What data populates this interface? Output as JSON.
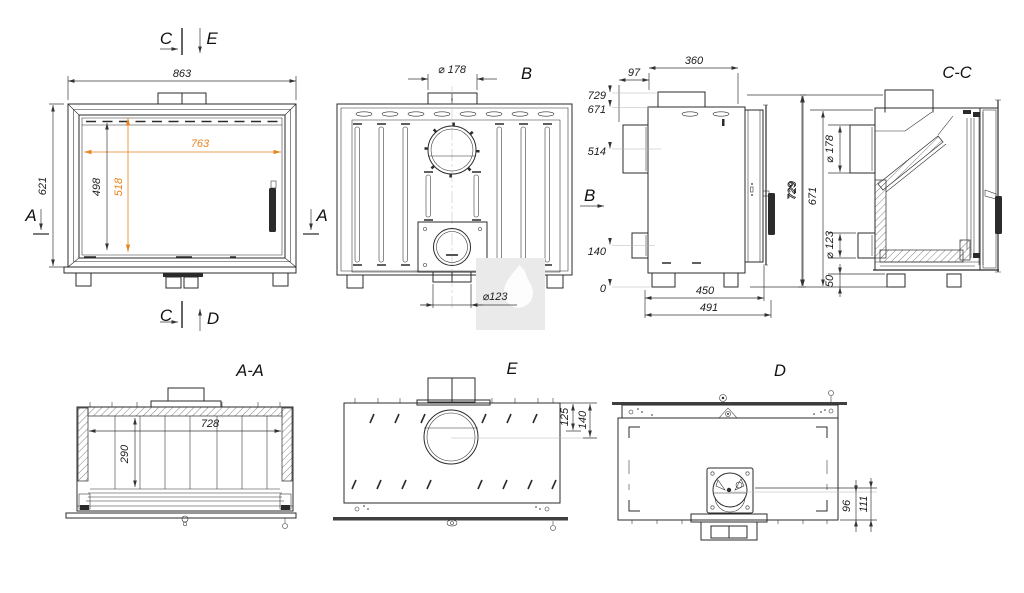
{
  "colors": {
    "line": "#2b2b2b",
    "dimension": "#3a3a3a",
    "accent_orange": "#e8831d",
    "leader_gray": "#b5b5b5",
    "watermark_bg": "#eaeaea"
  },
  "watermark": {
    "icon": "flame-icon"
  },
  "views": {
    "front": {
      "markers": {
        "c_top": "C",
        "e_top": "E",
        "a_left": "A",
        "a_right": "A",
        "c_bottom": "C",
        "d_bottom": "D"
      },
      "dims": {
        "overall_width": "863",
        "overall_height": "621",
        "glass_width": "763",
        "glass_height": "498",
        "glass_height_accent": "518"
      }
    },
    "rear": {
      "label": "B",
      "dims": {
        "flue_diameter": "⌀ 178",
        "outlet_diameter": "⌀123"
      }
    },
    "side": {
      "label": "B",
      "dims": {
        "top_depth": "360",
        "flue_offset": "97",
        "levels": [
          "729",
          "671",
          "514",
          "140",
          "0"
        ],
        "overall_height": "729",
        "depth_inner": "450",
        "depth_overall": "491"
      }
    },
    "section_cc": {
      "label": "C-C",
      "dims": {
        "overall_height": "729",
        "body_height": "671",
        "flue_diameter": "⌀ 178",
        "outlet_diameter": "⌀ 123",
        "base_height": "50"
      }
    },
    "section_aa": {
      "label": "A-A",
      "dims": {
        "inner_width": "728",
        "inner_height": "290"
      }
    },
    "top_e": {
      "label": "E",
      "dims": {
        "front_offset": "125",
        "center_offset": "140"
      }
    },
    "bottom_d": {
      "label": "D",
      "dims": {
        "front_offset": "96",
        "center_offset": "111"
      }
    }
  }
}
